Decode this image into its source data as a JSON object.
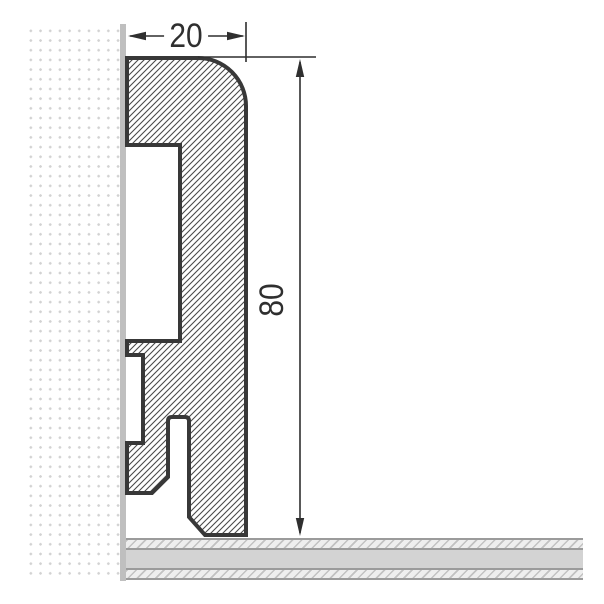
{
  "drawing": {
    "subject": "skirting-board-profile-cross-section"
  },
  "dimensions": {
    "width": {
      "label": "20"
    },
    "height": {
      "label": "80"
    }
  },
  "colors": {
    "outline": "#383838",
    "hatch_line": "#4a4a4a",
    "dimension": "#2f2f2f",
    "wall_surface": "#bfbfbf",
    "wall_dot": "#d2d2d2",
    "floor_band": "#d3d3d3",
    "floor_line": "#9b9b9b",
    "background": "#ffffff"
  }
}
